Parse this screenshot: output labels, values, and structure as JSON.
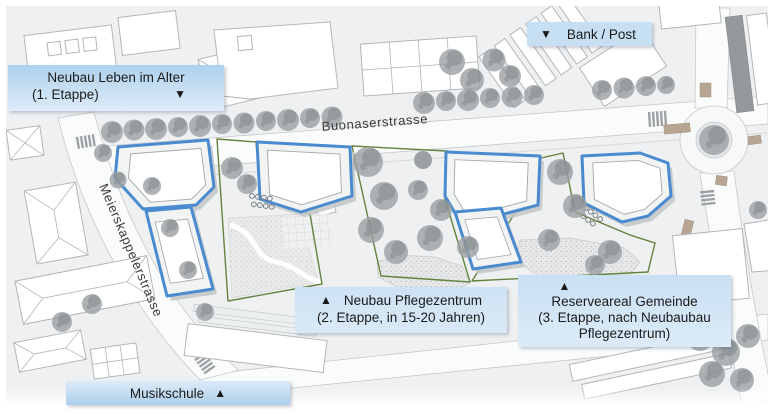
{
  "callouts": {
    "leben_im_alter": {
      "line1": "Neubau Leben im Alter",
      "line2": "(1. Etappe)",
      "arrow": "▼"
    },
    "bank_post": {
      "arrow": "▼",
      "label": "Bank / Post"
    },
    "pflegezentrum": {
      "arrow": "▲",
      "line1": "Neubau Pflegezentrum",
      "line2": "(2. Etappe, in 15-20 Jahren)"
    },
    "reserveareal": {
      "arrow": "▲",
      "line1": "Reserveareal Gemeinde",
      "line2": "(3. Etappe, nach Neubaubau",
      "line3": "Pflegezentrum)"
    },
    "musikschule": {
      "label": "Musikschule",
      "arrow": "▲"
    }
  },
  "streets": {
    "buonaserstrasse": "Buonaserstrasse",
    "meierskappelerstrasse": "Meierskappelerstrasse"
  },
  "legend_colors": {
    "new_building_outline": "#4a8bd0",
    "reserve_zone_outline": "#64833f",
    "callout_fill": "#c7dff3"
  }
}
